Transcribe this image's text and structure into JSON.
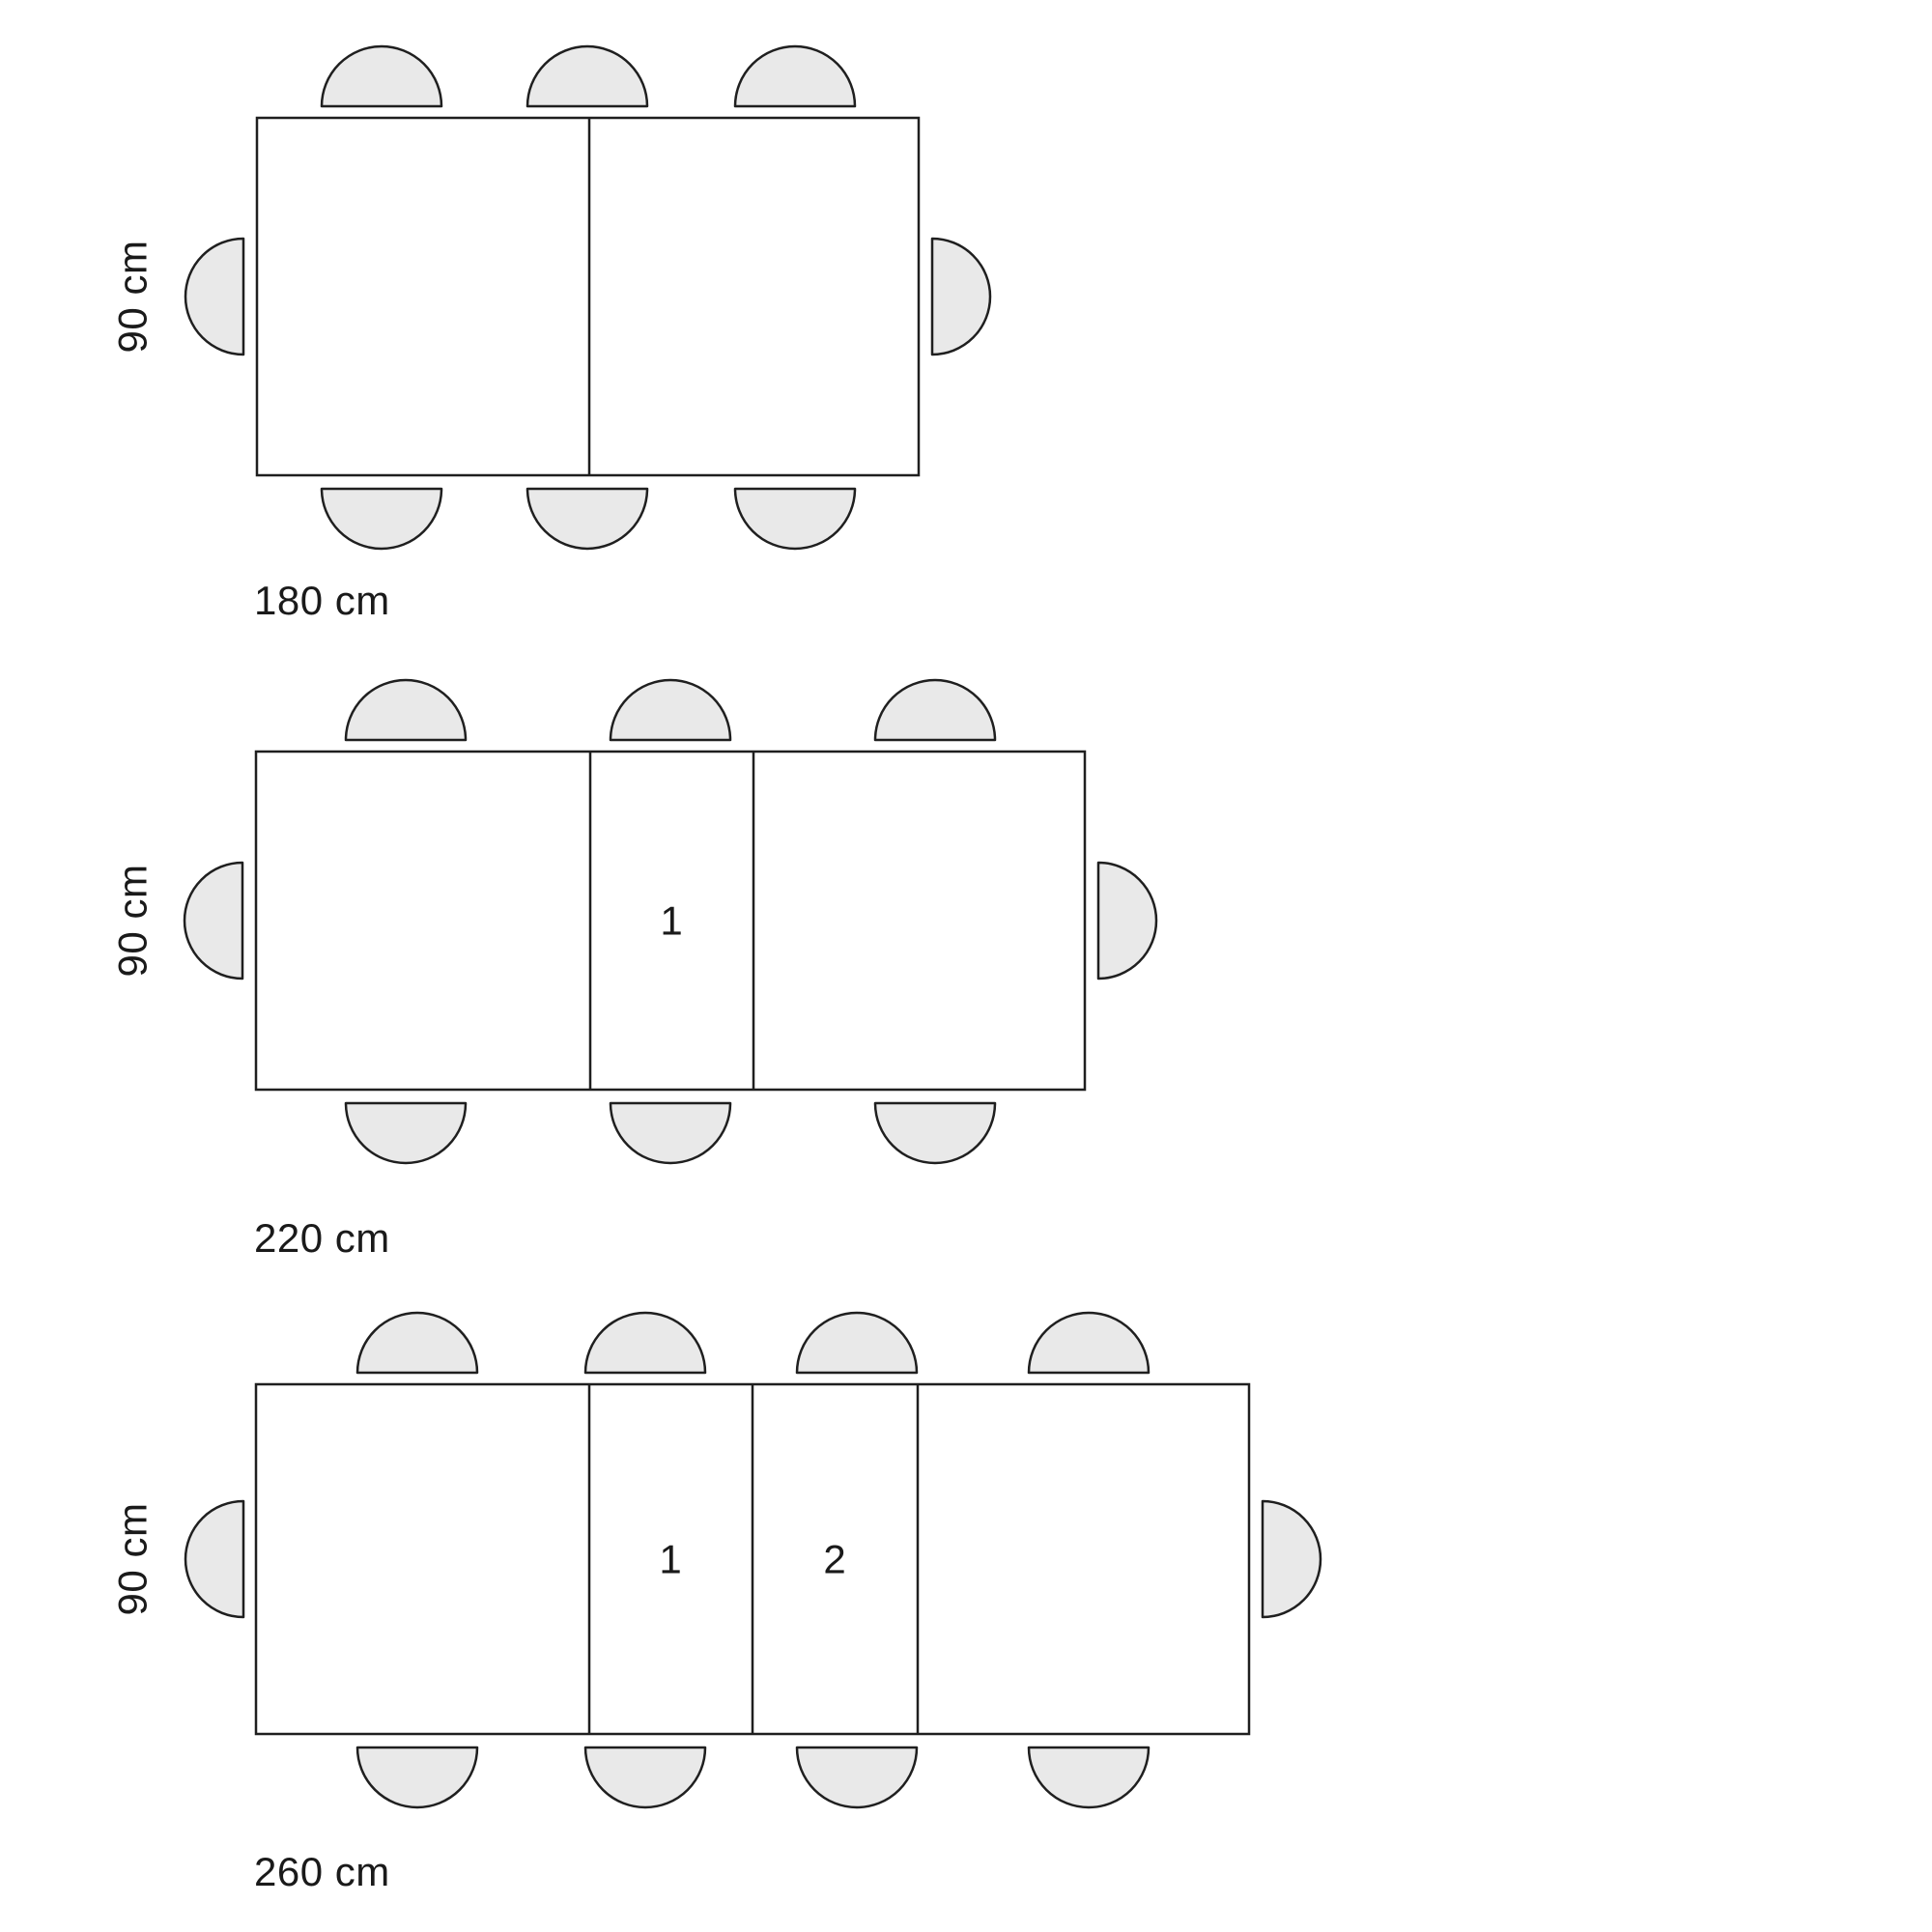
{
  "colors": {
    "background": "#ffffff",
    "table-fill": "#ffffff",
    "chair-fill": "#e9e9e9",
    "line": "#1f1f1f",
    "text": "#1a1a1a"
  },
  "diagrams": [
    {
      "name": "table-180",
      "depth_label": "90 cm",
      "width_label": "180 cm",
      "leaf_labels": []
    },
    {
      "name": "table-220",
      "depth_label": "90 cm",
      "width_label": "220 cm",
      "leaf_labels": [
        "1"
      ]
    },
    {
      "name": "table-260",
      "depth_label": "90 cm",
      "width_label": "260 cm",
      "leaf_labels": [
        "1",
        "2"
      ]
    }
  ]
}
